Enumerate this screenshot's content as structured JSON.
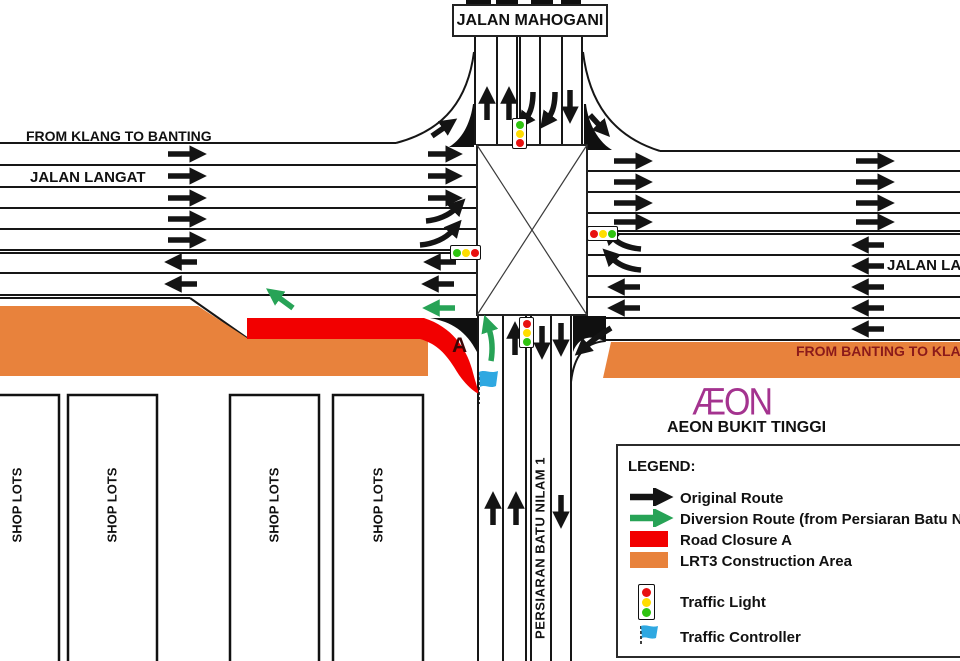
{
  "labels": {
    "jalan_mahogani": "JALAN MAHOGANI",
    "from_klang_to_banting": "FROM KLANG TO BANTING",
    "jalan_langat_left": "JALAN LANGAT",
    "jalan_langat_right": "JALAN LANGAT",
    "from_banting_to_klang": "FROM BANTING TO KLANG",
    "closure_point": "A",
    "persiaran_batu_nilam": "PERSIARAN BATU NILAM 1",
    "shop_lots": "SHOP LOTS",
    "aeon_logo": "ÆON",
    "aeon_store": "AEON BUKIT TINGGI"
  },
  "legend": {
    "title": "LEGEND:",
    "items": [
      {
        "key": "original",
        "label": "Original Route"
      },
      {
        "key": "diversion",
        "label": "Diversion Route (from Persiaran Batu Nilam"
      },
      {
        "key": "closure",
        "label": "Road Closure  A"
      },
      {
        "key": "construction",
        "label": "LRT3 Construction Area"
      },
      {
        "key": "traffic_light",
        "label": "Traffic Light"
      },
      {
        "key": "traffic_controller",
        "label": "Traffic Controller"
      }
    ]
  },
  "colors": {
    "original_route": "#141414",
    "diversion_route": "#27a356",
    "road_closure": "#f20000",
    "construction_area": "#e8823c",
    "traffic_controller_flag": "#2fa8e1",
    "aeon_magenta": "#a4338f",
    "banting_text_maroon": "#8b1a1a",
    "closure_letter": "#3d0606",
    "light_red": "#e81111",
    "light_yellow": "#ffdd00",
    "light_green": "#2fc410"
  }
}
